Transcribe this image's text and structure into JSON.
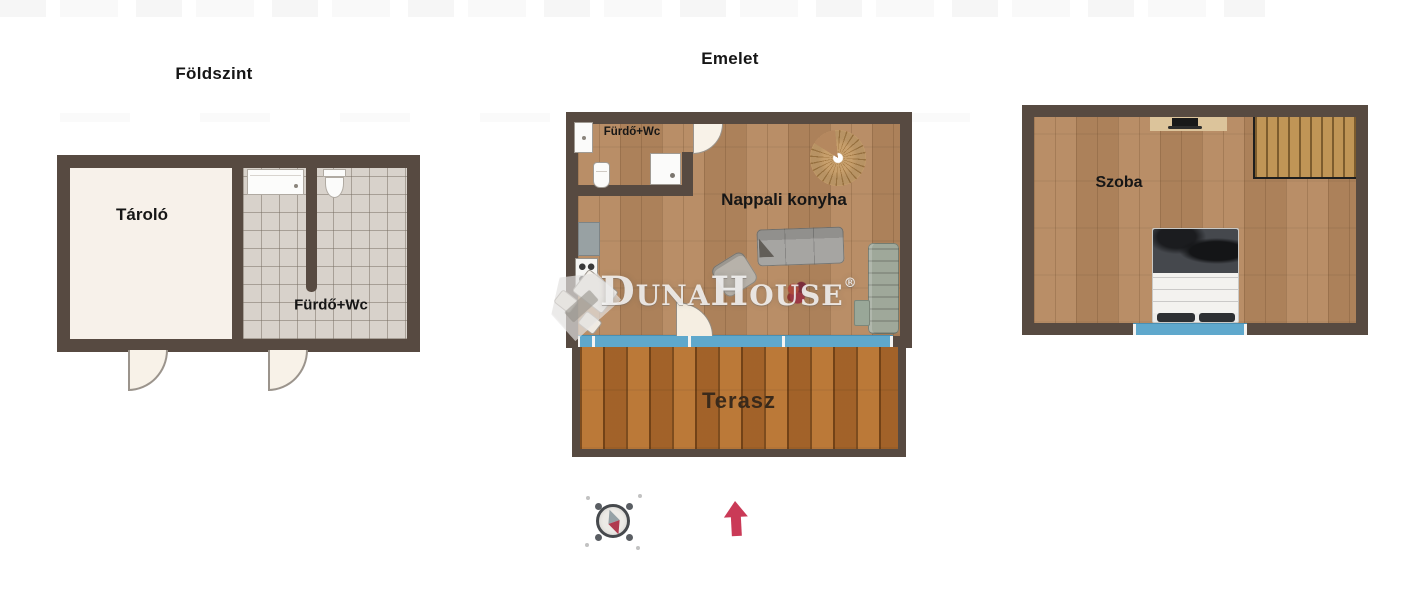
{
  "document": {
    "type": "real-estate floor plan"
  },
  "plans": {
    "ground": {
      "title": "Földszint",
      "rooms": [
        {
          "name": "Tároló"
        },
        {
          "name": "Fürdő+Wc"
        }
      ]
    },
    "upper": {
      "title": "Emelet",
      "rooms": [
        {
          "name": "Fürdő+Wc"
        },
        {
          "name": "Nappali konyha"
        },
        {
          "name": "Terasz"
        }
      ]
    },
    "attic": {
      "rooms": [
        {
          "name": "Szoba"
        }
      ]
    }
  },
  "watermark": {
    "brand": "DunaHouse",
    "registered": "®"
  },
  "icons": {
    "compass": "compass-icon",
    "north_arrow": "north-arrow-icon"
  },
  "colors": {
    "wall": "#574a41",
    "room_cream": "#f7f1ea",
    "tile_grey": "#d8d2cb",
    "wood_floor": "#b5885f",
    "terrace_wood": "#b06c2e",
    "window_blue": "#5fa8cc",
    "stair_tan": "#c09556",
    "label_black": "#161616",
    "terrace_label": "#3a2a1b",
    "arrow_red": "#ca3a57"
  }
}
